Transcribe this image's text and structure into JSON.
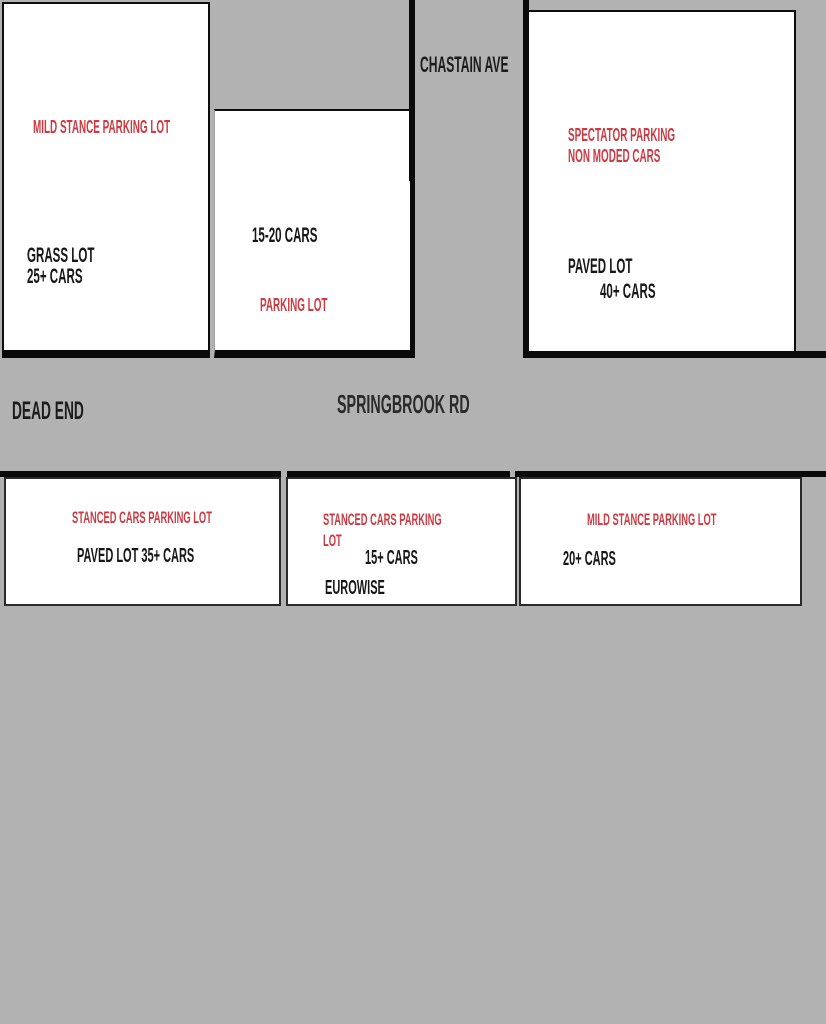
{
  "palette": {
    "background": "#b2b2b2",
    "lot_fill": "#ffffff",
    "line_black": "#0a0a0a",
    "text_black": "#161616",
    "text_red": "#cc3a42"
  },
  "roads": {
    "chastain_ave": "CHASTAIN AVE",
    "springbrook_rd": "SPRINGBROOK RD",
    "dead_end": "DEAD END"
  },
  "lots": {
    "top_left": {
      "title": "MILD STANCE PARKING LOT",
      "surface": "GRASS LOT",
      "capacity": "25+ CARS"
    },
    "top_middle": {
      "capacity": "15-20 CARS",
      "label": "PARKING LOT"
    },
    "top_right": {
      "title_line1": "SPECTATOR PARKING",
      "title_line2": "NON MODED CARS",
      "surface": "PAVED LOT",
      "capacity": "40+ CARS"
    },
    "bottom_left": {
      "title": "STANCED CARS PARKING LOT",
      "details": "PAVED LOT 35+ CARS"
    },
    "bottom_middle": {
      "title_line1": "STANCED CARS PARKING",
      "title_line2": "LOT",
      "capacity": "15+ CARS",
      "brand": "EUROWISE"
    },
    "bottom_right": {
      "title": "MILD STANCE PARKING LOT",
      "capacity": "20+ CARS"
    }
  }
}
